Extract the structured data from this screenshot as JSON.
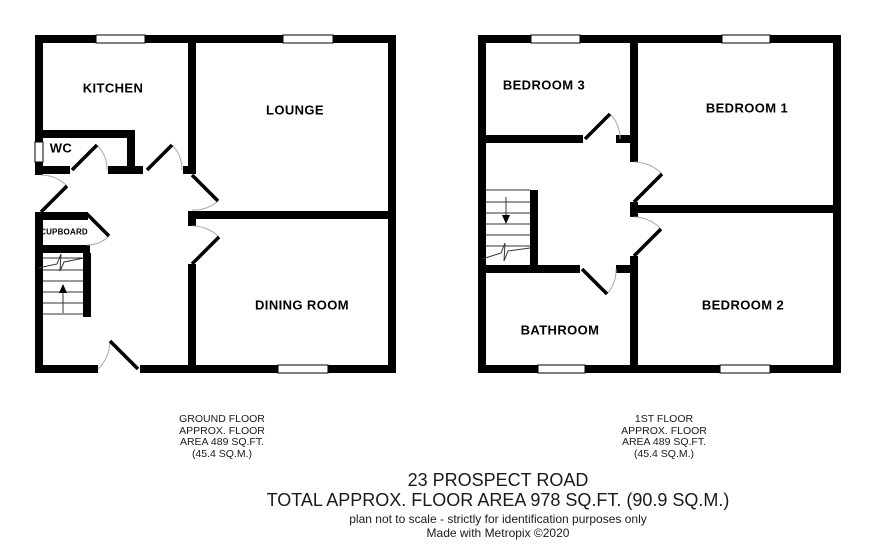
{
  "floors": {
    "ground": {
      "rooms": {
        "kitchen": "KITCHEN",
        "lounge": "LOUNGE",
        "wc": "WC",
        "cupboard": "CUPBOARD",
        "dining": "DINING ROOM"
      },
      "caption": [
        "GROUND FLOOR",
        "APPROX. FLOOR",
        "AREA 489 SQ.FT.",
        "(45.4 SQ.M.)"
      ]
    },
    "first": {
      "rooms": {
        "bedroom3": "BEDROOM 3",
        "bedroom1": "BEDROOM 1",
        "bedroom2": "BEDROOM 2",
        "bathroom": "BATHROOM"
      },
      "caption": [
        "1ST FLOOR",
        "APPROX. FLOOR",
        "AREA 489 SQ.FT.",
        "(45.4 SQ.M.)"
      ]
    }
  },
  "footer": {
    "address": "23 PROSPECT ROAD",
    "total_area": "TOTAL APPROX. FLOOR AREA 978 SQ.FT. (90.9 SQ.M.)",
    "disclaimer": "plan not to scale - strictly for identification purposes only",
    "credit": "Made with Metropix ©2020"
  },
  "colors": {
    "wall": "#000000",
    "window": "#ffffff",
    "door_arc": "#aaaaaa",
    "background": "#ffffff",
    "text": "#000000"
  }
}
